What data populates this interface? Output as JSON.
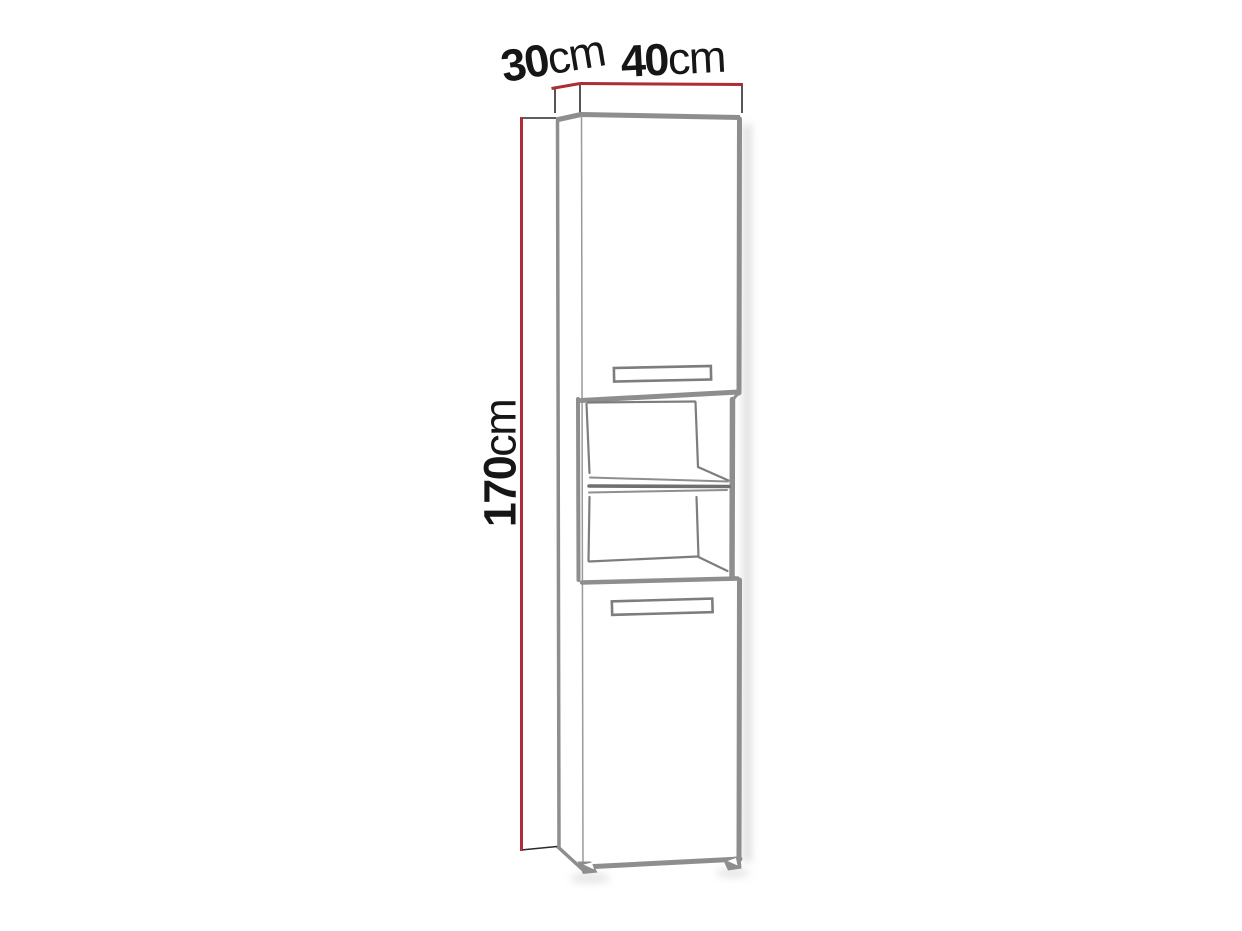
{
  "diagram": {
    "type": "furniture-dimension-diagram",
    "subject": "tall bathroom cabinet with top door, open two-compartment shelf niche, bottom door and plinth feet",
    "dimensions": [
      {
        "id": "depth",
        "value": "30",
        "unit": "cm"
      },
      {
        "id": "width",
        "value": "40",
        "unit": "cm"
      },
      {
        "id": "height",
        "value": "170",
        "unit": "cm"
      }
    ]
  },
  "theme": {
    "dimension_line": "#ab2f34",
    "sketch_stroke": "#8e8e8e",
    "sketch_stroke_dark": "#6f6f6f",
    "sketch_stroke_mid": "#7d7d7d",
    "sketch_stroke_light": "#9a9a9a",
    "thin_line": "#2a2a2a",
    "label_text": "#161616",
    "shadow": "#c6c6c6",
    "background": "#ffffff"
  }
}
